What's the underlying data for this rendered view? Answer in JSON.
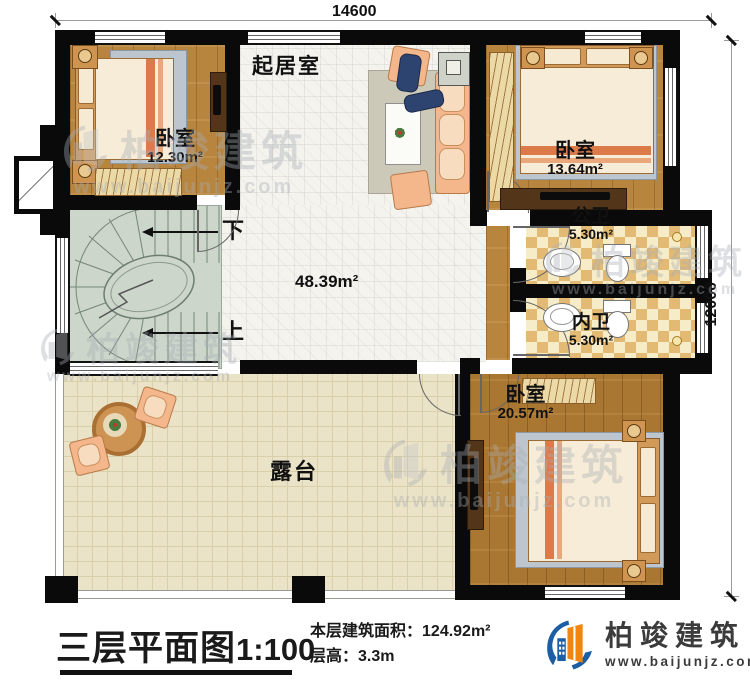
{
  "plan": {
    "dimensions": {
      "width_mm": "14600",
      "height_mm": "12000"
    },
    "rooms": {
      "living": {
        "name": "起居室"
      },
      "bedroom1": {
        "name": "卧室",
        "area": "12.30m²"
      },
      "bedroom2": {
        "name": "卧室",
        "area": "13.64m²"
      },
      "public_bath": {
        "name": "公卫",
        "area": "5.30m²"
      },
      "private_bath": {
        "name": "内卫",
        "area": "5.30m²"
      },
      "bedroom3": {
        "name": "卧室",
        "area": "20.57m²"
      },
      "hall": {
        "area": "48.39m²"
      },
      "terrace": {
        "name": "露台"
      }
    },
    "stairs": {
      "down_label": "下",
      "up_label": "上"
    }
  },
  "footer": {
    "title": "三层平面图",
    "scale": "1:100",
    "floor_area_label": "本层建筑面积：",
    "floor_area_value": "124.92m²",
    "floor_height_label": "层高：",
    "floor_height_value": "3.3m"
  },
  "brand": {
    "name": "柏竣建筑",
    "website": "www.baijunjz.com"
  },
  "watermark": {
    "name": "柏竣建筑",
    "website": "www.baijunjz.com"
  },
  "colors": {
    "wall": "#0a0a0a",
    "logo_blue": "#1b5ea6",
    "logo_orange": "#f0860f",
    "stair": "#ccd6cb",
    "wood": "#b8853e",
    "terrace": "#ebe3c7",
    "bath_dark": "#e3ba74",
    "bath_light": "#f6ecc8"
  }
}
